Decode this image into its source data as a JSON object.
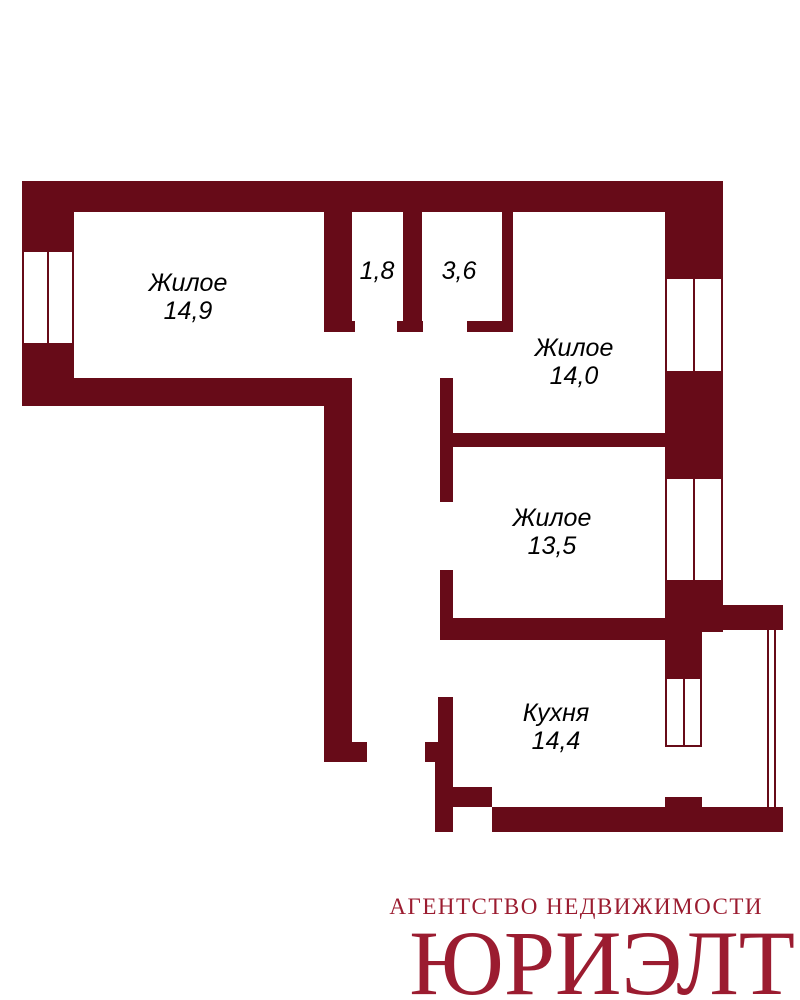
{
  "plan": {
    "wall_color": "#670b18",
    "label_color": "#000000",
    "background_color": "#ffffff",
    "rooms": [
      {
        "name": "living-room-1",
        "label": "Жилое",
        "area": "14,9"
      },
      {
        "name": "hallway-niche",
        "label": "",
        "area": "1,8"
      },
      {
        "name": "bathroom",
        "label": "",
        "area": "3,6"
      },
      {
        "name": "living-room-2",
        "label": "Жилое",
        "area": "14,0"
      },
      {
        "name": "living-room-3",
        "label": "Жилое",
        "area": "13,5"
      },
      {
        "name": "kitchen",
        "label": "Кухня",
        "area": "14,4"
      }
    ],
    "walls": [
      {
        "name": "top-outer-wall",
        "x": 22,
        "y": 181,
        "w": 701,
        "h": 31
      },
      {
        "name": "left-outer-wall-upper",
        "x": 22,
        "y": 212,
        "w": 52,
        "h": 38
      },
      {
        "name": "left-outer-wall-lower",
        "x": 22,
        "y": 345,
        "w": 52,
        "h": 61
      },
      {
        "name": "room1-bottom-outer-wall",
        "x": 22,
        "y": 378,
        "w": 330,
        "h": 28
      },
      {
        "name": "right-outer-wall-upper",
        "x": 665,
        "y": 212,
        "w": 58,
        "h": 65
      },
      {
        "name": "right-outer-wall-middle",
        "x": 665,
        "y": 373,
        "w": 58,
        "h": 104
      },
      {
        "name": "right-outer-wall-lower",
        "x": 665,
        "y": 582,
        "w": 58,
        "h": 50
      },
      {
        "name": "balcony-top-wall",
        "x": 723,
        "y": 605,
        "w": 60,
        "h": 25
      },
      {
        "name": "kitchen-right-wall",
        "x": 665,
        "y": 632,
        "w": 37,
        "h": 45
      },
      {
        "name": "kitchen-right-bump",
        "x": 665,
        "y": 797,
        "w": 37,
        "h": 10
      },
      {
        "name": "kitchen-bottom-wall",
        "x": 492,
        "y": 807,
        "w": 291,
        "h": 25
      },
      {
        "name": "kitchen-left-bottom-wall",
        "x": 435,
        "y": 762,
        "w": 18,
        "h": 70
      },
      {
        "name": "kitchen-bottom-step",
        "x": 453,
        "y": 787,
        "w": 39,
        "h": 20
      },
      {
        "name": "hall-left-wall",
        "x": 324,
        "y": 212,
        "w": 28,
        "h": 109
      },
      {
        "name": "hall-left-wall-foot",
        "x": 324,
        "y": 321,
        "w": 31,
        "h": 11
      },
      {
        "name": "hall-bath-divider-wall",
        "x": 403,
        "y": 212,
        "w": 19,
        "h": 109
      },
      {
        "name": "hall-bath-divider-foot",
        "x": 397,
        "y": 321,
        "w": 26,
        "h": 11
      },
      {
        "name": "bath-right-wall",
        "x": 502,
        "y": 212,
        "w": 11,
        "h": 109
      },
      {
        "name": "bath-right-wall-foot",
        "x": 467,
        "y": 321,
        "w": 46,
        "h": 11
      },
      {
        "name": "corridor-left-wall",
        "x": 324,
        "y": 406,
        "w": 28,
        "h": 336
      },
      {
        "name": "corridor-left-wall-foot",
        "x": 324,
        "y": 742,
        "w": 43,
        "h": 20
      },
      {
        "name": "rooms-left-wall-upper",
        "x": 440,
        "y": 378,
        "w": 13,
        "h": 124
      },
      {
        "name": "rooms-left-wall-lower",
        "x": 440,
        "y": 570,
        "w": 13,
        "h": 70
      },
      {
        "name": "room2-room3-divider-wall",
        "x": 453,
        "y": 433,
        "w": 212,
        "h": 14
      },
      {
        "name": "room3-kitchen-divider-wall",
        "x": 453,
        "y": 618,
        "w": 212,
        "h": 22
      },
      {
        "name": "kitchen-left-wall",
        "x": 438,
        "y": 697,
        "w": 15,
        "h": 65
      },
      {
        "name": "kitchen-door-foot",
        "x": 425,
        "y": 742,
        "w": 13,
        "h": 20
      }
    ],
    "windows": [
      {
        "name": "room1-window",
        "x": 22,
        "y": 250,
        "w": 52,
        "h": 95
      },
      {
        "name": "room2-window",
        "x": 665,
        "y": 277,
        "w": 58,
        "h": 96
      },
      {
        "name": "room3-window",
        "x": 665,
        "y": 477,
        "w": 58,
        "h": 105
      },
      {
        "name": "kitchen-window",
        "x": 665,
        "y": 677,
        "w": 37,
        "h": 70
      }
    ],
    "railing": {
      "name": "balcony-railing",
      "x": 767,
      "y": 630,
      "w": 9,
      "h": 177
    },
    "labels": [
      {
        "name": "living-room-1-label",
        "cx": 188,
        "y": 269,
        "lines": [
          "Жилое",
          "14,9"
        ]
      },
      {
        "name": "hallway-area-label",
        "cx": 377,
        "y": 257,
        "lines": [
          "1,8"
        ]
      },
      {
        "name": "bathroom-area-label",
        "cx": 459,
        "y": 257,
        "lines": [
          "3,6"
        ]
      },
      {
        "name": "living-room-2-label",
        "cx": 574,
        "y": 334,
        "lines": [
          "Жилое",
          "14,0"
        ]
      },
      {
        "name": "living-room-3-label",
        "cx": 552,
        "y": 504,
        "lines": [
          "Жилое",
          "13,5"
        ]
      },
      {
        "name": "kitchen-label",
        "cx": 556,
        "y": 699,
        "lines": [
          "Кухня",
          "14,4"
        ]
      }
    ]
  },
  "logo": {
    "tagline": "АГЕНТСТВО НЕДВИЖИМОСТИ",
    "brand": "ЮРИЭЛТ",
    "color": "#9b1c30"
  }
}
